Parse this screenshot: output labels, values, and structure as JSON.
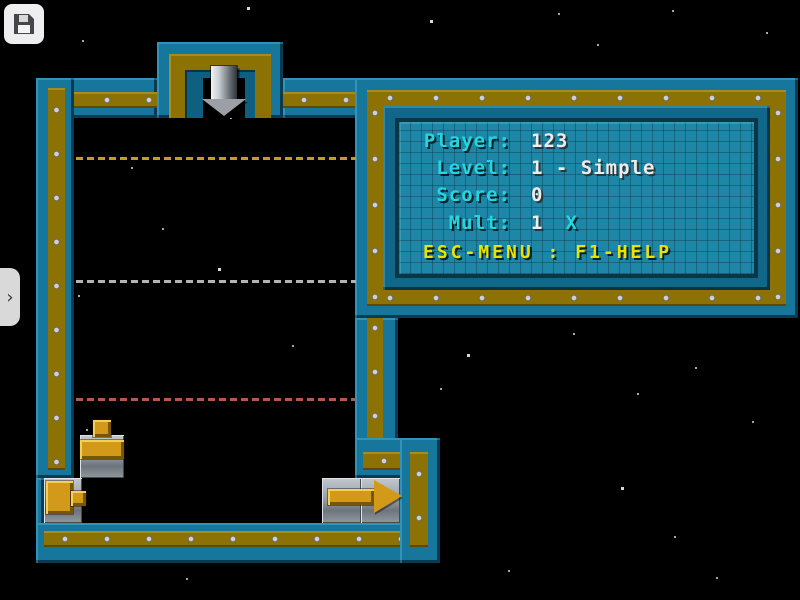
{
  "screen": {
    "title": "pipe-game-screen"
  },
  "toolbar": {
    "save_button": {
      "icon": "floppy-save-icon"
    }
  },
  "sidebar_toggle": {
    "icon": "chevron-right-icon",
    "glyph": "›"
  },
  "hud": {
    "rows": [
      {
        "label": "Player:",
        "value": "123"
      },
      {
        "label": "Level:",
        "value": "1 - Simple"
      },
      {
        "label": "Score:",
        "value": "0"
      },
      {
        "label": "Mult:",
        "value": "1",
        "suffix": "X"
      }
    ],
    "footer": "ESC-MENU : F1-HELP"
  },
  "playfield": {
    "guide_lines": [
      {
        "y": 157,
        "color": "#c89a26"
      },
      {
        "y": 280,
        "color": "#b4b4b4"
      },
      {
        "y": 398,
        "color": "#b45a4a"
      }
    ],
    "pieces": [
      {
        "name": "drop-arrow",
        "x": 202,
        "y": 66
      },
      {
        "name": "t-pipe",
        "x": 80,
        "y": 435
      },
      {
        "name": "source-block",
        "x": 44,
        "y": 478
      },
      {
        "name": "exit-arrow",
        "x": 326,
        "y": 480
      }
    ]
  },
  "colors": {
    "frame_teal": "#16769c",
    "frame_olive": "#8c7104",
    "panel_fill": "#1e86a6",
    "text_cyan": "#25d6e0",
    "text_white": "#ececec",
    "text_yellow": "#e8e400",
    "pipe_gold": "#d29a18",
    "tile_gray": "#9aa0a8"
  },
  "stars": [
    [
      247,
      7
    ],
    [
      558,
      13
    ],
    [
      672,
      10
    ],
    [
      597,
      44
    ],
    [
      766,
      32
    ],
    [
      430,
      20
    ],
    [
      82,
      40
    ],
    [
      230,
      117
    ],
    [
      131,
      167
    ],
    [
      162,
      228
    ],
    [
      218,
      268
    ],
    [
      78,
      295
    ],
    [
      292,
      345
    ],
    [
      86,
      429
    ],
    [
      440,
      388
    ],
    [
      467,
      354
    ],
    [
      573,
      333
    ],
    [
      637,
      393
    ],
    [
      695,
      367
    ],
    [
      752,
      421
    ],
    [
      621,
      487
    ],
    [
      674,
      536
    ],
    [
      508,
      570
    ],
    [
      186,
      578
    ],
    [
      716,
      577
    ]
  ]
}
